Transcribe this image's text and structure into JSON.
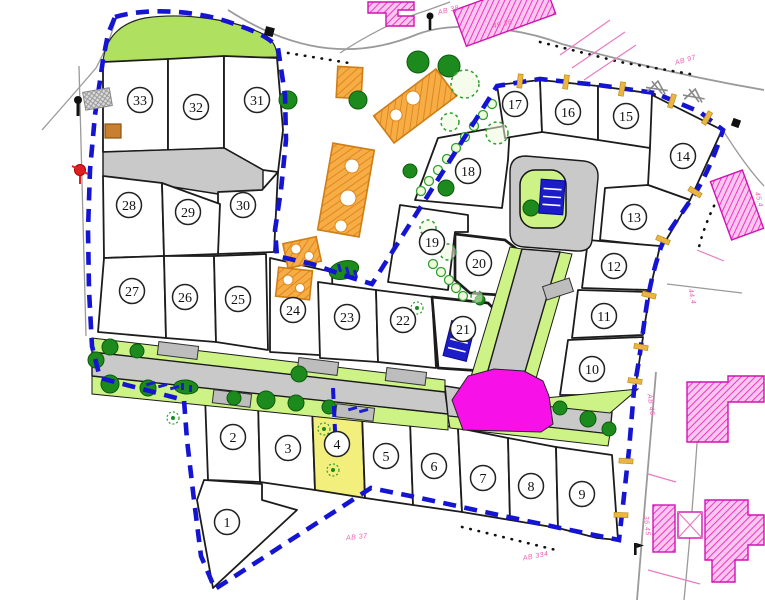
{
  "map": {
    "kind": "subdivision-site-plan",
    "lots": [
      {
        "number": "1",
        "x": 227,
        "y": 522,
        "highlighted": false
      },
      {
        "number": "2",
        "x": 233,
        "y": 437,
        "highlighted": false
      },
      {
        "number": "3",
        "x": 288,
        "y": 448,
        "highlighted": false
      },
      {
        "number": "4",
        "x": 337,
        "y": 444,
        "highlighted": true
      },
      {
        "number": "5",
        "x": 386,
        "y": 456,
        "highlighted": false
      },
      {
        "number": "6",
        "x": 434,
        "y": 466,
        "highlighted": false
      },
      {
        "number": "7",
        "x": 483,
        "y": 478,
        "highlighted": false
      },
      {
        "number": "8",
        "x": 531,
        "y": 486,
        "highlighted": false
      },
      {
        "number": "9",
        "x": 582,
        "y": 494,
        "highlighted": false
      },
      {
        "number": "10",
        "x": 592,
        "y": 369,
        "highlighted": false
      },
      {
        "number": "11",
        "x": 604,
        "y": 316,
        "highlighted": false
      },
      {
        "number": "12",
        "x": 614,
        "y": 266,
        "highlighted": false
      },
      {
        "number": "13",
        "x": 634,
        "y": 217,
        "highlighted": false
      },
      {
        "number": "14",
        "x": 683,
        "y": 156,
        "highlighted": false
      },
      {
        "number": "15",
        "x": 626,
        "y": 116,
        "highlighted": false
      },
      {
        "number": "16",
        "x": 568,
        "y": 112,
        "highlighted": false
      },
      {
        "number": "17",
        "x": 515,
        "y": 104,
        "highlighted": false
      },
      {
        "number": "18",
        "x": 468,
        "y": 171,
        "highlighted": false
      },
      {
        "number": "19",
        "x": 432,
        "y": 242,
        "highlighted": false
      },
      {
        "number": "20",
        "x": 479,
        "y": 263,
        "highlighted": false
      },
      {
        "number": "21",
        "x": 463,
        "y": 329,
        "highlighted": false
      },
      {
        "number": "22",
        "x": 403,
        "y": 320,
        "highlighted": false
      },
      {
        "number": "23",
        "x": 347,
        "y": 317,
        "highlighted": false
      },
      {
        "number": "24",
        "x": 293,
        "y": 310,
        "highlighted": false
      },
      {
        "number": "25",
        "x": 238,
        "y": 299,
        "highlighted": false
      },
      {
        "number": "26",
        "x": 185,
        "y": 297,
        "highlighted": false
      },
      {
        "number": "27",
        "x": 132,
        "y": 291,
        "highlighted": false
      },
      {
        "number": "28",
        "x": 129,
        "y": 205,
        "highlighted": false
      },
      {
        "number": "29",
        "x": 188,
        "y": 212,
        "highlighted": false
      },
      {
        "number": "30",
        "x": 243,
        "y": 205,
        "highlighted": false
      },
      {
        "number": "31",
        "x": 257,
        "y": 100,
        "highlighted": false
      },
      {
        "number": "32",
        "x": 196,
        "y": 107,
        "highlighted": false
      },
      {
        "number": "33",
        "x": 140,
        "y": 100,
        "highlighted": false
      }
    ],
    "parcel_labels": [
      {
        "text": "AB 38",
        "x": 449,
        "y": 12,
        "rot": -14
      },
      {
        "text": "49 36",
        "x": 503,
        "y": 26,
        "rot": -14
      },
      {
        "text": "AB 97",
        "x": 686,
        "y": 62,
        "rot": -16
      },
      {
        "text": "AB 37",
        "x": 357,
        "y": 539,
        "rot": -6
      },
      {
        "text": "AB 334",
        "x": 536,
        "y": 558,
        "rot": -11
      },
      {
        "text": "44.4",
        "x": 690,
        "y": 297,
        "rot": 78
      },
      {
        "text": "45.4",
        "x": 757,
        "y": 200,
        "rot": 75
      },
      {
        "text": "AB 46",
        "x": 649,
        "y": 405,
        "rot": 82
      },
      {
        "text": "36.45",
        "x": 645,
        "y": 526,
        "rot": 84
      }
    ],
    "palette": {
      "boundary": "#1414d2",
      "green-area": "#b0e060",
      "green-verge": "#cdf285",
      "tree-dark": "#1d8a1d",
      "tree-light": "#2f9f2f",
      "lot-highlight": "#f3ef7d",
      "plaza": "#f711e8",
      "parking": "#1c1cc8",
      "tick": "#eab543",
      "pink-text": "#ef5fb0",
      "existing-building": "#f7ad45",
      "neighbor-building": "#fbc7ef"
    }
  }
}
